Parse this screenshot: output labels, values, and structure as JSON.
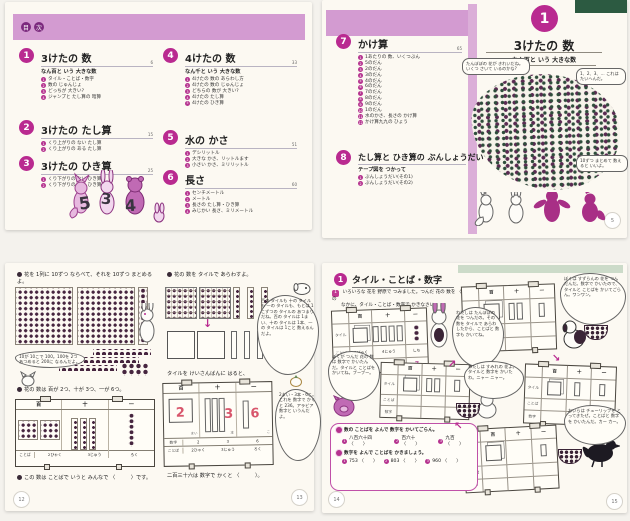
{
  "colors": {
    "band_pink": "#d39bd1",
    "accent_magenta": "#b92a90",
    "dark_badge": "#7c2a7e",
    "digit_red": "#d8566c",
    "green_dark": "#2c5a41",
    "green_light": "#ccdbc9",
    "dot_dark": "#46253f"
  },
  "glyphs": {
    "arrow_down": "↓",
    "arrow_ne": "↗",
    "arrow_se": "↘",
    "arrow_nw": "↖"
  },
  "toc": {
    "header_chars": [
      "目",
      "次"
    ],
    "illustration_numbers": [
      "5",
      "3",
      "4"
    ],
    "sections": [
      {
        "num": "1",
        "title": "3けたの 数",
        "subtitle": "なん百と いう 大きな数",
        "page": "6",
        "items": [
          "タイル・ことば・数字",
          "数の じゅんじょ",
          "どっちが 大きい?",
          "ジャンプと たし算の 暗算"
        ]
      },
      {
        "num": "2",
        "title": "3けたの たし算",
        "page": "15",
        "items": [
          "くり上がりの ない たし算",
          "くり上がりの ある たし算"
        ]
      },
      {
        "num": "3",
        "title": "3けたの ひき算",
        "page": "25",
        "items": [
          "くり下がりの ない ひき算",
          "くり下がりの ある ひき算"
        ]
      },
      {
        "num": "4",
        "title": "4けたの 数",
        "subtitle": "なん千と いう 大きな数",
        "page": "33",
        "items": [
          "4けたの 数の あらわし方",
          "4けたの 数の じゅんじょ",
          "どちらの 数が 大きい?",
          "4けたの たし算",
          "4けたの ひき算"
        ]
      },
      {
        "num": "5",
        "title": "水の かさ",
        "page": "51",
        "items": [
          "デシリットル",
          "大きな かさ、リットルます",
          "小さい かさ、ミリリットル"
        ]
      },
      {
        "num": "6",
        "title": "長さ",
        "page": "60",
        "items": [
          "センチメートル",
          "メートル",
          "長さの たし算・ひき算",
          "みじかい 長さ、ミリメートル"
        ]
      },
      {
        "num": "7",
        "title": "かけ算",
        "page": "65",
        "items": [
          "1あたりの 数、いくつぶん",
          "5のだん",
          "2のだん",
          "3のだん",
          "4のだん",
          "6のだん",
          "7のだん",
          "8のだん",
          "9のだん",
          "1のだん",
          "水のかさ、長さの かけ算",
          "かけ算九九の ひょう"
        ]
      },
      {
        "num": "8",
        "title": "たし算と ひき算の ぶんしょうだい",
        "subtitle": "テープ図を つかって",
        "page": "107",
        "items": [
          "ぶんしょうだい(その1)",
          "ぶんしょうだい(その2)"
        ]
      }
    ]
  },
  "opener": {
    "num": "1",
    "title": "3けたの 数",
    "subtitle": "なん百と いう 大きな数",
    "bubble_question": "たんぽぽの 花が きれいだね。いくつ さいて いるのかな?",
    "bubble_count": "1、2、3、… これは たいへんだ。",
    "bubble_hint": "10ずつ まとめて 数えると いいよ。",
    "page": "5"
  },
  "tiles_spread": {
    "left": {
      "intro": "花を 1列に 10ずつ ならべて、それを 10ずつ まとめるよ。",
      "bubble": "10が 10こで 100。100を 2つ あつめると 200に なるんだよ。",
      "caption": "花の 数は 百が 2つ、十が 3つ、一が 6つ。",
      "cols": [
        "百",
        "十",
        "一"
      ],
      "words_label": "ことば",
      "words": [
        "2ひゃく",
        "3じゅう",
        "ろく"
      ],
      "footer": "この 数は ことばで いうと みんなで 〈　　　〉です。",
      "page": "12"
    },
    "right": {
      "intro": "花の 数を タイルで あらわすよ。",
      "bubble_long": "百の タイルも 十の タイルも 一の タイルも、もとは 1こずつの タイルの あつまりだね。百の タイルは 1まい、十の タイルは 1本、一の タイルは 1こと 数えるんだよ。",
      "caption": "タイルを けいさんばんに はると、",
      "cols": [
        "百",
        "十",
        "一"
      ],
      "units": [
        "まい",
        "本",
        "こ"
      ],
      "digits": [
        "2",
        "3",
        "6"
      ],
      "digits_label": "数字",
      "words_label": "ことば",
      "words": [
        "2ひゃく",
        "3じゅう",
        "ろく"
      ],
      "bubble_number": "2まい・3本・6こ。これを 数字で かくと 236。アラビア数字と いうんだよ。",
      "footer": "二百三十六は 数字で かくと 〈　　　〉。",
      "page": "13"
    }
  },
  "practice_spread": {
    "board": {
      "rows": [
        "タイル",
        "ことば",
        "数字"
      ],
      "cols": [
        "百",
        "十",
        "一"
      ]
    },
    "left": {
      "num": "1",
      "title": "タイル・ことば・数字",
      "problem_num": "1",
      "problem_line1": "いろいろな 花を 野原で つみました。つんだ 花の 数を 〈　〉の",
      "problem_line2": "なかに、タイル・ことば・数字で かきなさい。",
      "board_words": [
        "3びゃく",
        "4じゅう",
        "しち"
      ],
      "board_digits": [
        "3",
        "4",
        "7"
      ],
      "rabbit_bubble": "わたしは たんぽぽの 花を つんだの。その 数を タイルで あらわしたから、ことばと 数字も かいてね。",
      "pig_bubble": "ぼくが つんだ 花の 数は 数字で かいたんだ。タイルと ことばを かいてね。ブーブー。",
      "ex1_label": "数の ことばを よんで 数字を かいてごらん。",
      "ex1": [
        "八百六十四 〈　　〉",
        "百六十 〈　　〉",
        "九百 〈　　〉"
      ],
      "ex2_label": "数字を よんで ことばを かきましょう。",
      "ex2": [
        "753 〈　　〉",
        "803 〈　　〉",
        "960 〈　　〉"
      ],
      "page": "14"
    },
    "right": {
      "dog_bubble": "ぼくは すずらんの 花を つんだんだ。数字で かいたので、タイルと ことばを かいてごらん。ワンワン。",
      "cat_bubble": "わたしは すみれの 花よ。タイルと 数字を かいたわ。ニャー ニャー。",
      "crow_bubble": "おいらは チューリップを とってきたぜ。ことばと 数字を かいたんだ。カー カー。",
      "page": "15"
    }
  }
}
